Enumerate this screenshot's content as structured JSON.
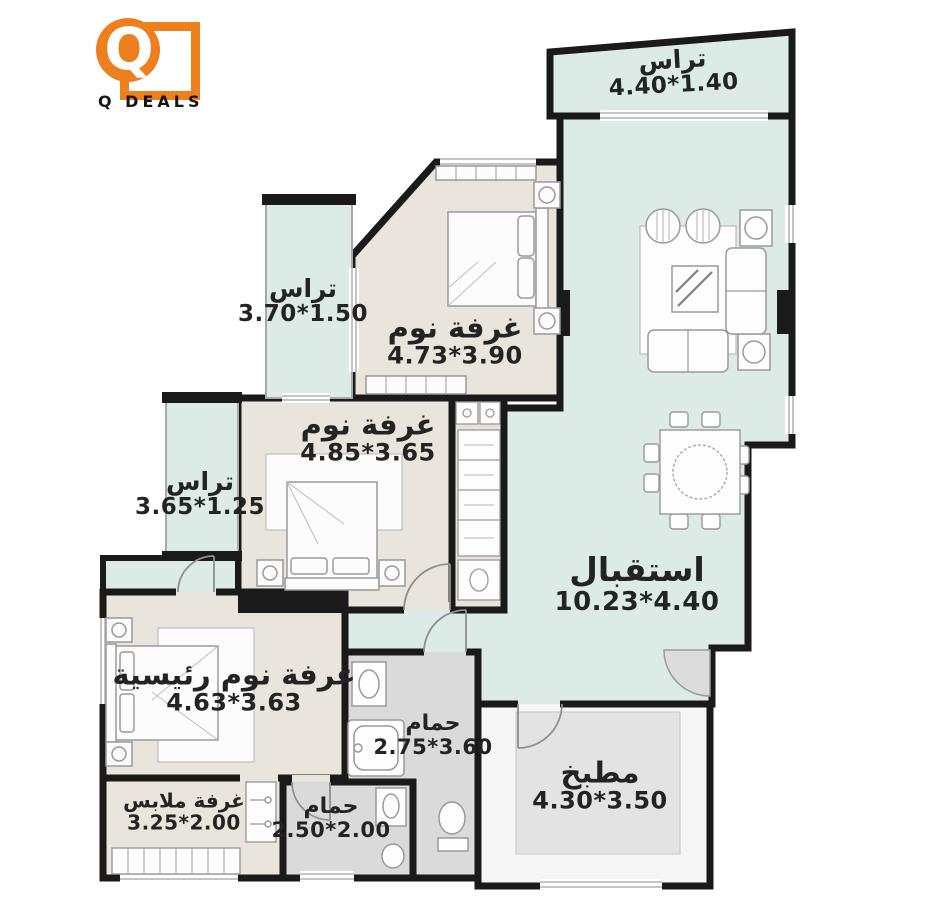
{
  "brand": {
    "name": "Q DEALS",
    "logo_letter": "Q",
    "accent": "#ee7f1e"
  },
  "palette": {
    "wall": "#1a1a1a",
    "terrace_mint": "#dcebe6",
    "room_beige": "#e9e4dc",
    "bath_gray": "#dadada",
    "kitchen_inner": "#e3e3e3"
  },
  "rooms": {
    "terrace_top": {
      "label": "تراس",
      "dims": "4.40*1.40"
    },
    "reception": {
      "label": "استقبال",
      "dims": "10.23*4.40"
    },
    "bedroom1": {
      "label": "غرفة نوم",
      "dims": "4.73*3.90"
    },
    "terrace_upper_left": {
      "label": "تراس",
      "dims": "3.70*1.50"
    },
    "bedroom2": {
      "label": "غرفة نوم",
      "dims": "4.85*3.65"
    },
    "terrace_lower_left": {
      "label": "تراس",
      "dims": "3.65*1.25"
    },
    "master_bedroom": {
      "label": "غرفة نوم رئيسية",
      "dims": "4.63*3.63"
    },
    "dressing": {
      "label": "غرفة ملابس",
      "dims": "3.25*2.00"
    },
    "bathroom1": {
      "label": "حمام",
      "dims": "2.75*3.60"
    },
    "bathroom2": {
      "label": "حمام",
      "dims": "2.50*2.00"
    },
    "kitchen": {
      "label": "مطبخ",
      "dims": "4.30*3.50"
    }
  }
}
